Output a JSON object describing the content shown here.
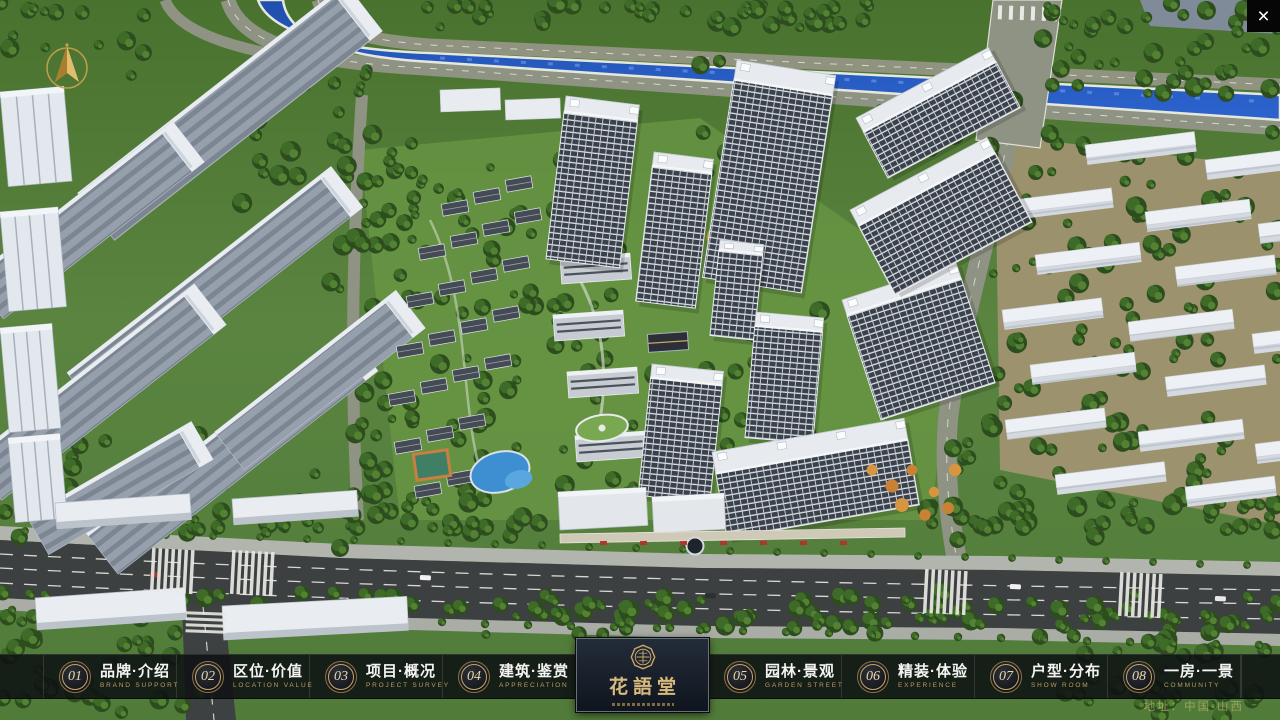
{
  "window": {
    "close_icon": "×"
  },
  "nav": {
    "items": [
      {
        "num": "01",
        "zh": "品牌·介绍",
        "en": "BRAND SUPPORT"
      },
      {
        "num": "02",
        "zh": "区位·价值",
        "en": "LOCATION VALUE"
      },
      {
        "num": "03",
        "zh": "项目·概况",
        "en": "PROJECT SURVEY"
      },
      {
        "num": "04",
        "zh": "建筑·鉴赏",
        "en": "APPRECIATION"
      },
      {
        "num": "05",
        "zh": "园林·景观",
        "en": "GARDEN STREET"
      },
      {
        "num": "06",
        "zh": "精装·体验",
        "en": "EXPERIENCE"
      },
      {
        "num": "07",
        "zh": "户型·分布",
        "en": "SHOW ROOM"
      },
      {
        "num": "08",
        "zh": "一房·一景",
        "en": "COMMUNITY"
      }
    ]
  },
  "logo": {
    "title": "花語堂"
  },
  "footer": {
    "address": "地址：中国·山西"
  },
  "colors": {
    "gold": "#c8a768",
    "logo_gold": "#d9ba7e",
    "nav_text": "#f4f4f2",
    "nav_en": "#bb9d60",
    "bar_bg": "#101318",
    "river_blue": "#2558b8"
  }
}
